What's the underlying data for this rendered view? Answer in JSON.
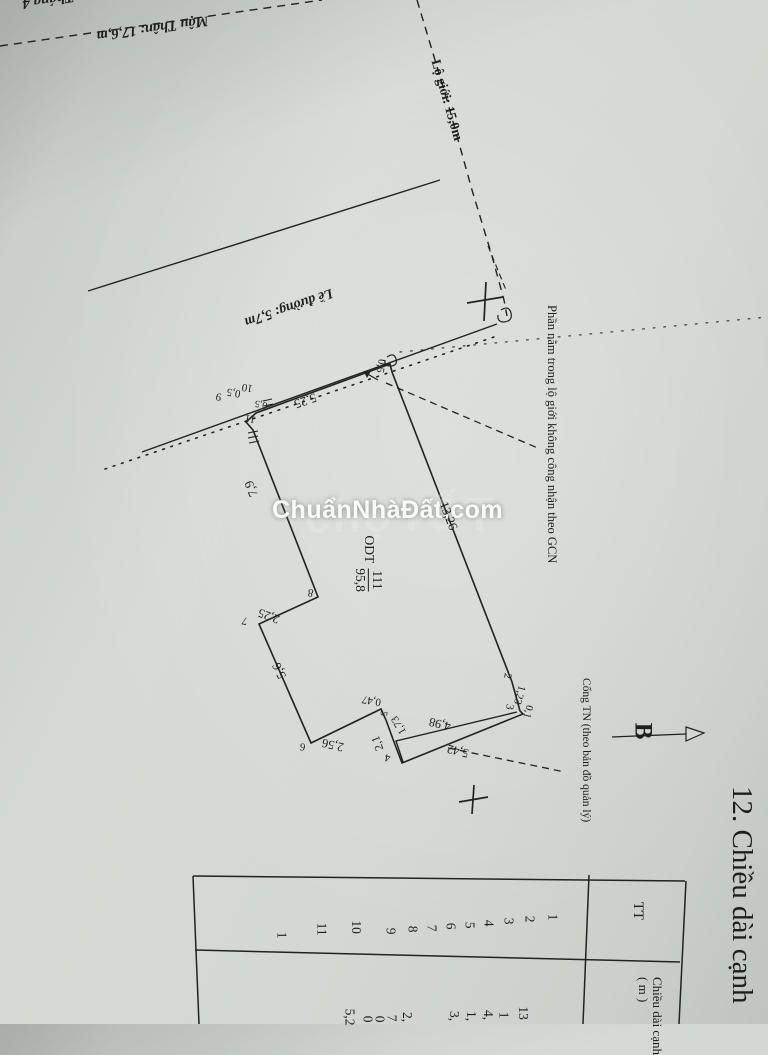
{
  "streets": {
    "street_top_cut": "Tháng 4",
    "street_mau_than": "Mậu Thân: 17,6,m",
    "road_margin": "Lề đường: 5,7m",
    "boundary_line": "Lộ giới: 15,0m"
  },
  "parcel": {
    "land_use_code": "ODT",
    "plot_number": "111",
    "area": "95,8",
    "edges": {
      "e_1_2": "13,26",
      "e_11_1": "5,25",
      "e_8_9": "7,9",
      "e_7_8": "2,25",
      "e_6_7": "5,6",
      "e_5_6": "2,56",
      "e_4_5": "2,1",
      "jog_047": "0,47",
      "jog_173": "1,73",
      "inner_line": "4,98",
      "e_3_4": "5,42",
      "e_2_3": "1,23",
      "jog_01": "0,1",
      "jog_05_a": "0,5",
      "jog_05_b": "0,5",
      "jog_05_c": "0,5"
    },
    "vertices": {
      "v2": "2",
      "v3": "3",
      "v4": "4",
      "v5": "5",
      "v6": "6",
      "v7": "7",
      "v8": "8",
      "v9": "9",
      "v10": "10",
      "v11": "11"
    }
  },
  "annotations": {
    "in_boundary_note": "Phần nằm trong lộ giới không công nhận theo GCN",
    "culvert_note": "Cống TN (theo bản đồ quản lý)",
    "north_label": "B",
    "section_title": "12. Chiều dài cạnh"
  },
  "watermark": {
    "main": "ChuẩnNhàĐất.com",
    "ghost": "chợTỐT"
  },
  "table": {
    "header_tt": "TT",
    "header_length_line1": "Chiều dài cạnh",
    "header_length_line2": "( m )",
    "tt_values": [
      "1",
      "2",
      "3",
      "4",
      "5",
      "6",
      "7",
      "8",
      "9",
      "10",
      "11",
      "1"
    ],
    "length_fragments": [
      "13",
      "1",
      "4,",
      "1,",
      "3,",
      "2,",
      "7",
      "0",
      "0",
      "5,2"
    ]
  },
  "colors": {
    "ink": "#222222",
    "paper": "#d4d7d3",
    "watermark_white": "#ffffff"
  }
}
